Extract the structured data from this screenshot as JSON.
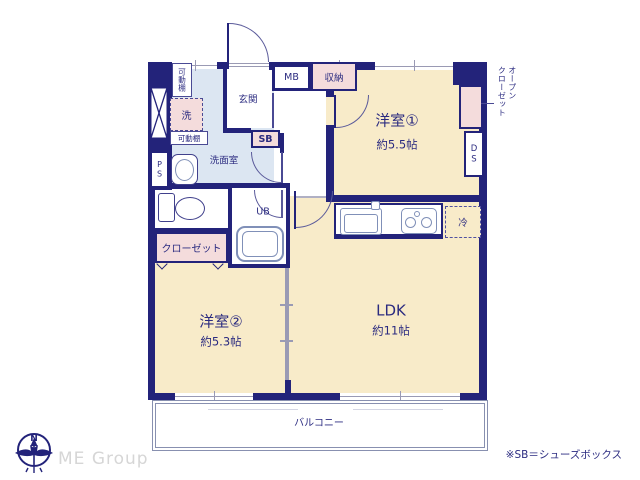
{
  "plan": {
    "rooms": {
      "yoshitsu1": {
        "name": "洋室①",
        "size": "約5.5帖"
      },
      "yoshitsu2": {
        "name": "洋室②",
        "size": "約5.3帖"
      },
      "ldk": {
        "name": "LDK",
        "size": "約11帖"
      },
      "genkan": {
        "name": "玄関"
      },
      "senmenshitsu": {
        "name": "洗面室"
      },
      "unit_bath": {
        "name": "UB"
      },
      "balcony": {
        "name": "バルコニー"
      },
      "closet": {
        "name": "クローゼット"
      },
      "open_closet": {
        "line1": "オープン",
        "line2": "クローゼット"
      }
    },
    "fixtures": {
      "meter_box": "MB",
      "storage": "収納",
      "shoe_box": "SB",
      "duct_space": "DS",
      "pipe_space": "PS",
      "refrigerator": "冷",
      "washer": "洗",
      "movable_shelf": "可動棚"
    },
    "colors": {
      "wall_navy": "#23237a",
      "room_cream": "#f8ebc9",
      "closet_pink": "#f4dcdc",
      "wet_area_blue": "#dce6f2",
      "label_navy": "#2b2b80",
      "logo_gray": "#d6d6d6"
    }
  },
  "footer": {
    "compass_n": "N",
    "logo_text": "ME Group",
    "note": "※SB＝シューズボックス"
  }
}
